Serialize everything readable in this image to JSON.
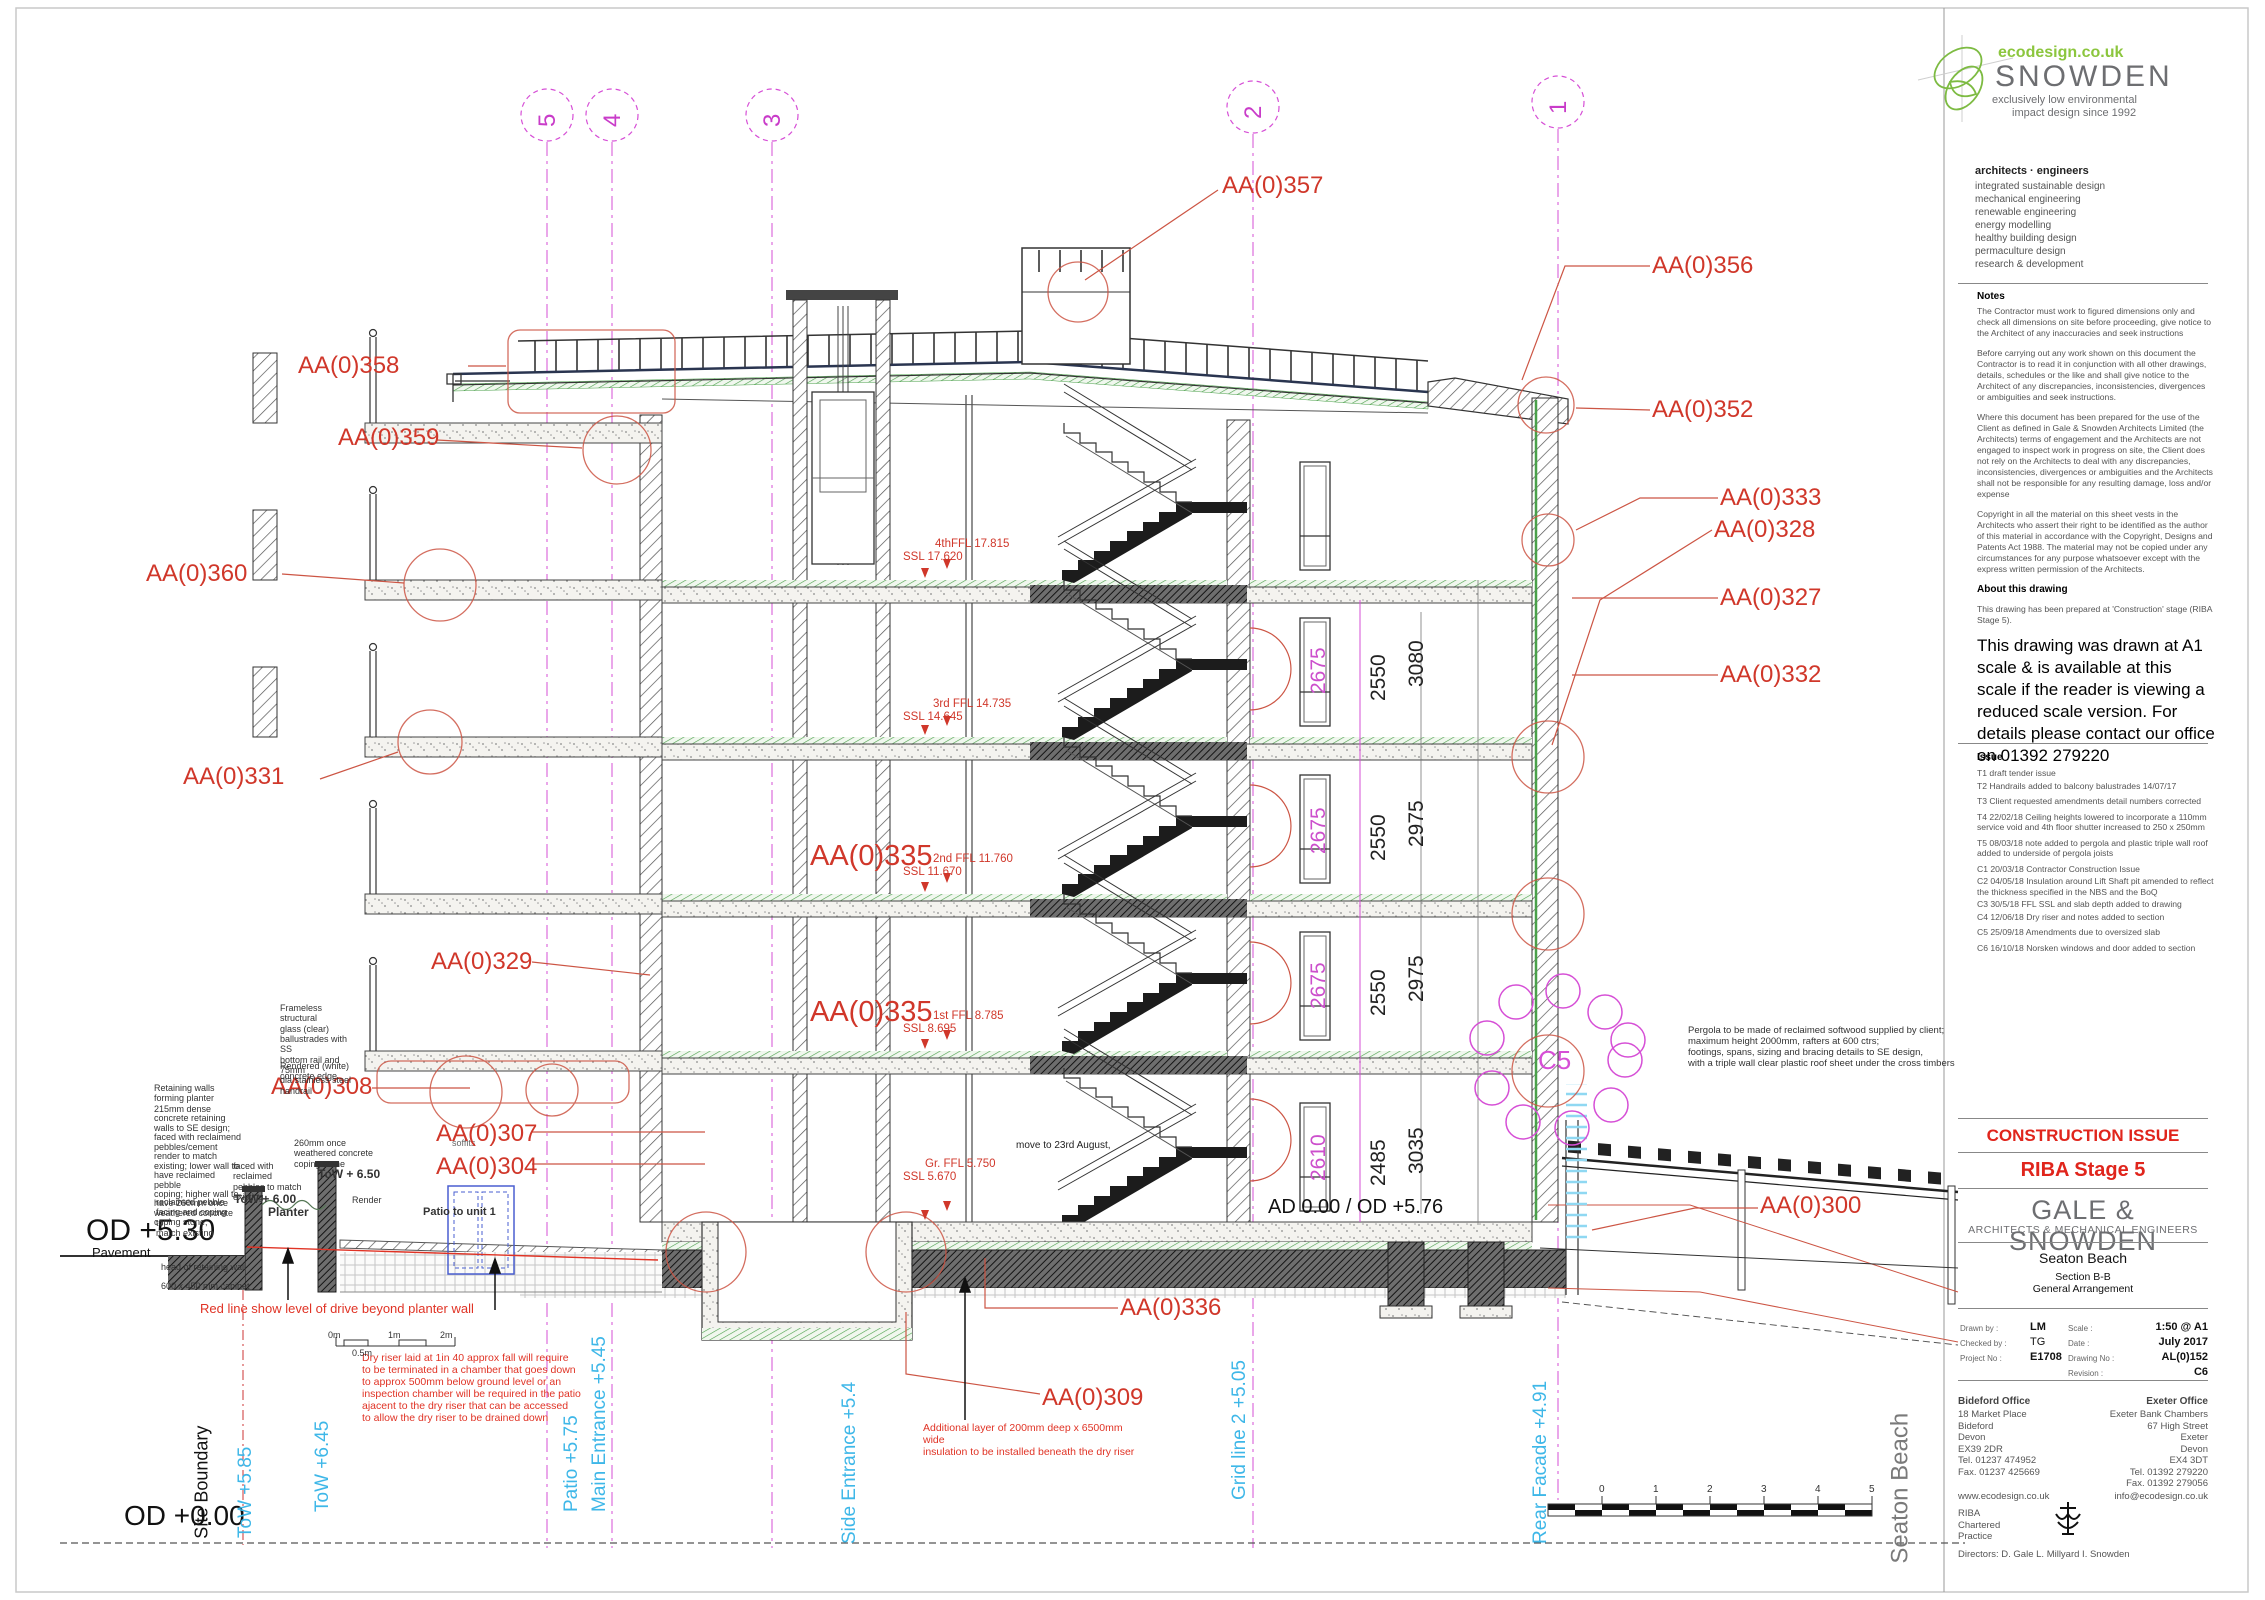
{
  "logo": {
    "url": "ecodesign.co.uk",
    "name": "SNOWDEN",
    "tagline1": "exclusively low environmental",
    "tagline2": "impact design since 1992"
  },
  "services": {
    "heading": "architects · engineers",
    "items": [
      "integrated sustainable design",
      "mechanical engineering",
      "renewable engineering",
      "energy modelling",
      "healthy building design",
      "permaculture design",
      "research & development"
    ]
  },
  "notes": {
    "heading": "Notes",
    "p1": "The Contractor must work to figured dimensions only and check all dimensions on site before proceeding, give notice to the Architect of any inaccuracies and seek instructions",
    "p2": "Before carrying out any work shown on this document the Contractor is to read it in conjunction with all other drawings, details, schedules or the like and shall give notice to the Architect of any discrepancies, inconsistencies, divergences or ambiguities and seek instructions.",
    "p3": "Where this document has been prepared for the use of the Client as defined in Gale & Snowden Architects Limited (the Architects) terms of engagement and the Architects are not engaged to inspect work in progress on site, the Client does not rely on the Architects to deal with any discrepancies, inconsistencies, divergences or ambiguities and the Architects shall not be responsible for any resulting damage, loss and/or expense",
    "p4": "Copyright in all the material on this sheet vests in the Architects who assert their right to be identified as the author of this material in accordance with the Copyright, Designs and Patents Act 1988. The material may not be copied under any circumstances for any purpose whatsoever except with the express written permission of the Architects.",
    "about_heading": "About this drawing",
    "about": "This drawing has been prepared at 'Construction' stage (RIBA Stage 5).",
    "large": "This drawing was drawn at A1 scale & is available at this scale if the reader is viewing a reduced scale version. For details please contact our office on 01392 279220"
  },
  "issue": {
    "heading": "Issue",
    "items": [
      "T1 draft tender issue",
      "T2 Handrails added to balcony balustrades   14/07/17",
      "T3  Client requested amendments detail numbers corrected",
      "T4  22/02/18 Ceiling heights lowered to incorporate a 110mm service void and 4th floor shutter increased to 250 x 250mm",
      "T5  08/03/18 note added to pergola and plastic triple wall roof added to underside of pergola joists",
      "C1 20/03/18  Contractor Construction Issue",
      "C2 04/05/18  Insulation around Lift Shaft pit amended to reflect the thickness specified in the NBS and the BoQ",
      "C3 30/5/18 FFL SSL and slab depth added to drawing",
      "C4 12/06/18 Dry riser and notes added to section",
      "C5 25/09/18  Amendments due to oversized slab",
      "C6 16/10/18 Norsken windows and door added to section"
    ]
  },
  "titleblock": {
    "status": "CONSTRUCTION ISSUE",
    "stage": "RIBA Stage 5",
    "firm": "GALE  &  SNOWDEN",
    "firm_sub": "ARCHITECTS & MECHANICAL ENGINEERS",
    "project": "Seaton Beach",
    "title1": "Section B-B",
    "title2": "General Arrangement",
    "drawn_by_label": "Drawn by :",
    "drawn_by": "LM",
    "checked_by_label": "Checked by :",
    "checked_by": "TG",
    "project_no_label": "Project No :",
    "project_no": "E1708",
    "scale_label": "Scale :",
    "scale": "1:50 @ A1",
    "date_label": "Date :",
    "date": "July 2017",
    "drawing_no_label": "Drawing No :",
    "drawing_no": "AL(0)152",
    "revision_label": "Revision :",
    "revision": "C6",
    "bideford": {
      "name": "Bideford Office",
      "lines": "18 Market Place\nBideford\nDevon\nEX39 2DR\nTel. 01237 474952\nFax. 01237 425669"
    },
    "exeter": {
      "name": "Exeter Office",
      "lines": "Exeter Bank Chambers\n67 High Street\nExeter\nDevon\nEX4 3DT\nTel. 01392 279220\nFax. 01392 279056"
    },
    "web": "www.ecodesign.co.uk",
    "email": "info@ecodesign.co.uk",
    "riba": "RIBA\nChartered\nPractice",
    "directors": "Directors:     D. Gale      L. Millyard      I. Snowden"
  },
  "grid": {
    "labels": [
      "5",
      "4",
      "3",
      "2",
      "1"
    ]
  },
  "callouts": {
    "aa357": "AA(0)357",
    "aa358": "AA(0)358",
    "aa359": "AA(0)359",
    "aa360": "AA(0)360",
    "aa331": "AA(0)331",
    "aa329": "AA(0)329",
    "aa308": "AA(0)308",
    "aa307": "AA(0)307",
    "aa304": "AA(0)304",
    "aa335": "AA(0)335",
    "aa336": "AA(0)336",
    "aa309": "AA(0)309",
    "aa356": "AA(0)356",
    "aa352": "AA(0)352",
    "aa333": "AA(0)333",
    "aa328": "AA(0)328",
    "aa327": "AA(0)327",
    "aa332": "AA(0)332",
    "aa300": "AA(0)300",
    "c5": "C5"
  },
  "levels": {
    "ffl4": "4thFFL 17.815",
    "ssl4": "SSL 17.620",
    "ffl3": "3rd FFL 14.735",
    "ssl3": "SSL 14.645",
    "ffl2": "2nd FFL 11.760",
    "ssl2": "SSL 11.670",
    "ffl1": "1st FFL 8.785",
    "ssl1": "SSL 8.695",
    "fflg": "Gr. FFL 5.750",
    "sslg": "SSL 5.670",
    "ad": "AD 0.00 / OD +5.76",
    "od530": "OD +5.30",
    "pavement": "Pavement",
    "od000": "OD +0.00"
  },
  "dims": {
    "f4": [
      "2675",
      "2550",
      "3080"
    ],
    "f3": [
      "2675",
      "2550",
      "2975"
    ],
    "f2": [
      "2675",
      "2550",
      "2975"
    ],
    "g": [
      "2610",
      "2485",
      "3035"
    ]
  },
  "drawing_notes": {
    "frameless": "Frameless structural\nglass (clear)\nballustrades with SS\nbottom rail and 75mm\ndia stainless steel\nhandrail",
    "rendered": "Rendered (white)\nconcrete edge",
    "retaining": "Retaining walls\nforming planter",
    "concrete215": "215mm dense\nconcrete retaining\nwalls to SE design;\nfaced with reclaimend\npebbles/cement\nrender to match\nexisting; lower wall to\nhave reclaimed pebble\ncoping; higher wall to\nhave 260mm once\nweathered concrete\ncoping stone;",
    "pebble": "reclaimed pebble\nfacing and coping to\nmatch existing",
    "coping260": "260mm once\nweathered concrete\ncoping stone",
    "faced": "faced with reclaimed\npebbles to match\nexisting",
    "headwall": "head of retaining wall",
    "cabinet": "600 x 450 mm cabinet",
    "render": "Render",
    "planter": "Planter",
    "tow600": "ToW + 6.00",
    "tow650": "ToW + 6.50",
    "patio_unit": "Patio to unit 1",
    "soffits": "soffits",
    "move": "move to 23rd August,",
    "drive": "Red line show level of drive beyond planter wall",
    "dryriser": "Dry riser laid at 1in 40 approx fall will require\nto be terminated in a chamber that goes down\nto approx 500mm below ground level or an\ninspection chamber will be required in the patio\najacent to the dry riser that can be accessed\nto allow the dry riser to be drained down",
    "insulation": "Additional layer of 200mm deep x 6500mm wide\ninsulation to be installed beneath the dry riser",
    "pergola": "Pergola to be made of reclaimed softwood supplied by client;\nmaximum height 2000mm, rafters at 600 ctrs;\nfootings, spans, sizing and bracing details to SE design,\nwith a triple wall clear plastic roof sheet under the cross timbers"
  },
  "verticals": {
    "site": "Site Boundary",
    "tow585": "ToW +5.85",
    "tow645": "ToW +6.45",
    "patio": "Patio +5.75",
    "main_ent": "Main Entrance +5.45",
    "side_ent": "Side Entrance +5.4",
    "grid2": "Grid line 2 +5.05",
    "rear": "Rear Facade +4.91",
    "beach": "Seaton Beach"
  },
  "scalebars": {
    "small": [
      "0m",
      "0.5m",
      "1m",
      "2m"
    ],
    "big": [
      "0",
      "1",
      "2",
      "3",
      "4",
      "5"
    ]
  },
  "colors": {
    "annotation_red": "#d0372a",
    "grid_magenta": "#d64fd6",
    "level_cyan": "#3eb7e8",
    "insulation_green": "#4aa04a",
    "title_red": "#e0251c",
    "brand_green": "#8CC63E",
    "brand_grey": "#6d6e71"
  }
}
